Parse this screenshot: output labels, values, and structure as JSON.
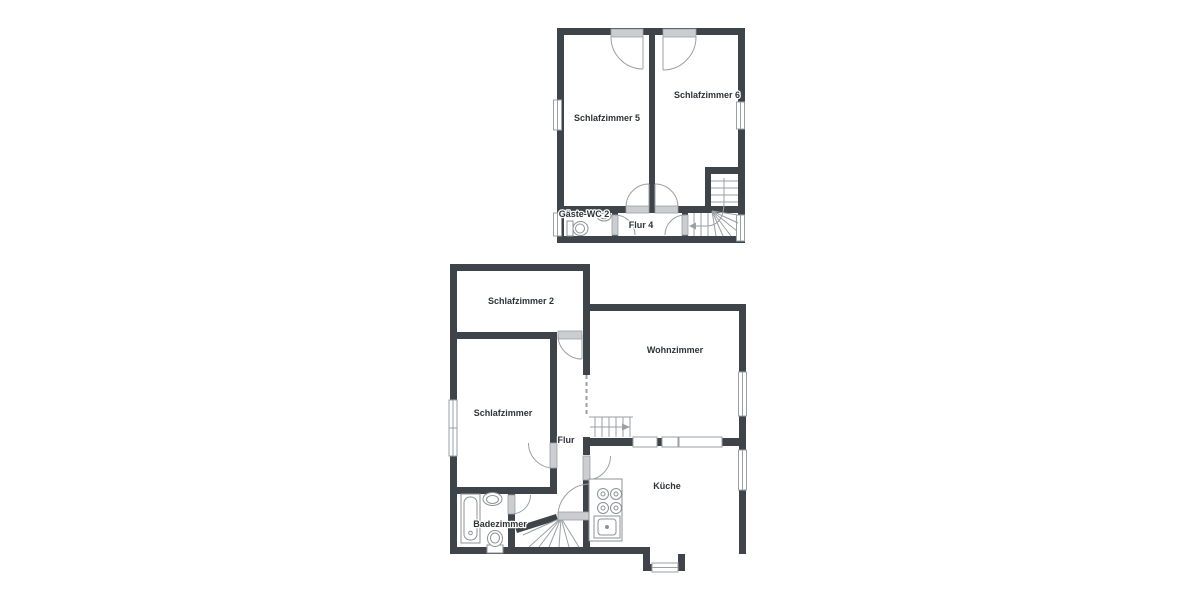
{
  "floorplan": {
    "upper_floor": {
      "rooms": [
        {
          "label": "Schlafzimmer 5"
        },
        {
          "label": "Schlafzimmer 6"
        },
        {
          "label": "Gäste-WC 2"
        },
        {
          "label": "Flur 4"
        }
      ]
    },
    "lower_floor": {
      "rooms": [
        {
          "label": "Schlafzimmer 2"
        },
        {
          "label": "Wohnzimmer"
        },
        {
          "label": "Schlafzimmer"
        },
        {
          "label": "Flur"
        },
        {
          "label": "Küche"
        },
        {
          "label": "Badezimmer"
        }
      ]
    },
    "colors": {
      "wall": "#3f444b",
      "door": "#cbcdd0",
      "outline": "#9ba0a4",
      "text": "#2e3338",
      "fixture": "#8d9296",
      "background": "#ffffff"
    }
  }
}
